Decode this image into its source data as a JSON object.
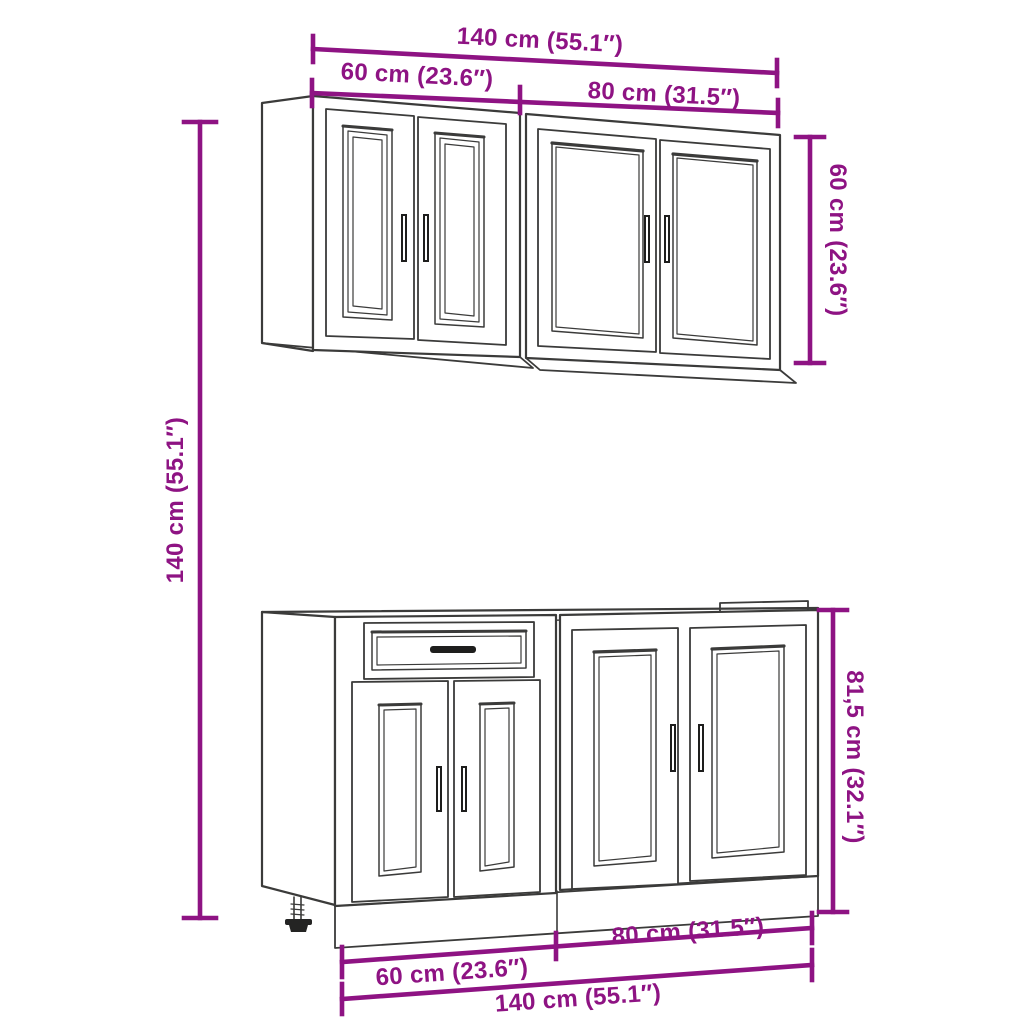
{
  "diagram": {
    "type": "furniture-dimension-diagram",
    "subject": "kitchen-cabinet-set-wall-and-base-units",
    "background_color": "#ffffff",
    "line_art_color": "#3b3b3a",
    "dimension_color": "#8e1383"
  },
  "labels": {
    "width_total_top": "140 cm (55.1″)",
    "width_wall_left_top": "60 cm (23.6″)",
    "width_wall_right_top": "80 cm (31.5″)",
    "height_overall_left": "140 cm (55.1″)",
    "height_wall_cabinet_right": "60 cm (23.6″)",
    "height_base_cabinet_right": "81,5 cm (32.1″)",
    "width_base_left_bottom": "60 cm (23.6″)",
    "width_base_right_bottom": "80 cm (31.5″)",
    "width_total_bottom": "140 cm (55.1″)"
  },
  "measurements": {
    "total_width_cm": 140,
    "total_width_in": 55.1,
    "left_cabinet_width_cm": 60,
    "left_cabinet_width_in": 23.6,
    "right_cabinet_width_cm": 80,
    "right_cabinet_width_in": 31.5,
    "overall_height_cm": 140,
    "overall_height_in": 55.1,
    "wall_cabinet_height_cm": 60,
    "wall_cabinet_height_in": 23.6,
    "base_cabinet_height_cm": 81.5,
    "base_cabinet_height_in": 32.1
  }
}
